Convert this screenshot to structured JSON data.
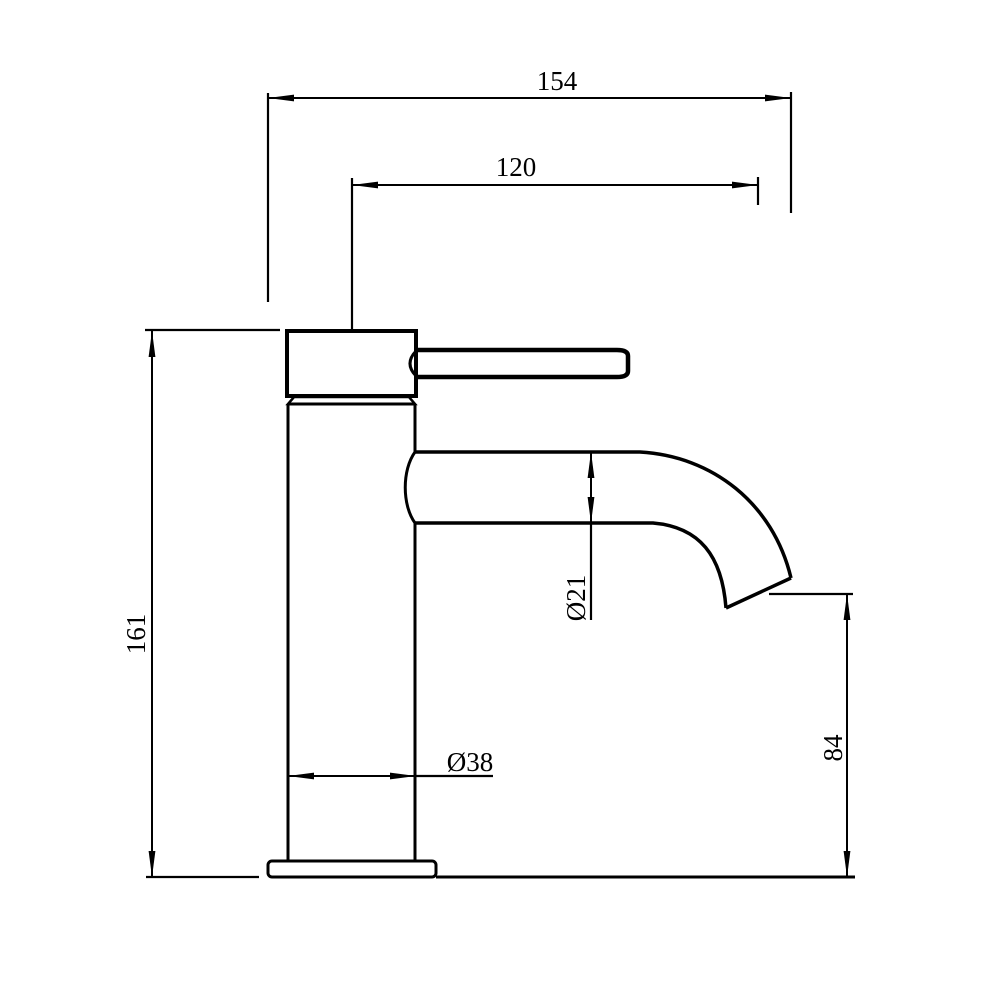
{
  "colors": {
    "background": "#ffffff",
    "line": "#000000"
  },
  "dimensions": {
    "overall_width_mm": "154",
    "spout_reach_mm": "120",
    "overall_height_mm": "161",
    "spout_diameter_mm": "Ø21",
    "body_diameter_mm": "Ø38",
    "outlet_height_mm": "84"
  }
}
